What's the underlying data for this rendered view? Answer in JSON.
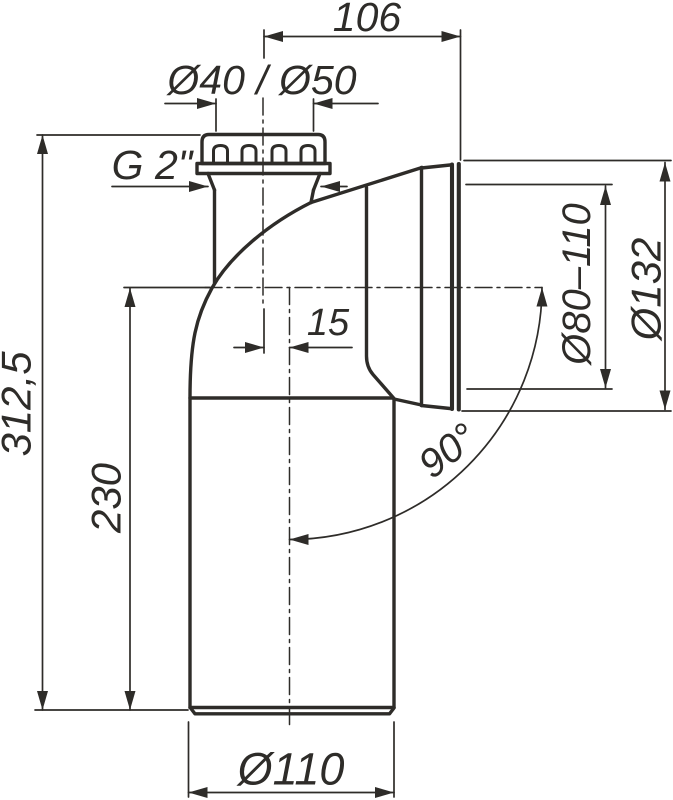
{
  "drawing": {
    "title": "WC connection elbow 90° technical drawing",
    "colors": {
      "ink": "#2e2c29",
      "background": "#ffffff"
    },
    "labels": {
      "top_width": "106",
      "inlet_diameters": "Ø40 / Ø50",
      "thread": "G 2\"",
      "total_height": "312,5",
      "outlet_axis_height": "230",
      "axis_offset": "15",
      "socket_inner_range": "Ø80–110",
      "socket_outer_diameter": "Ø132",
      "bend_angle": "90°",
      "pipe_diameter": "Ø110"
    }
  }
}
